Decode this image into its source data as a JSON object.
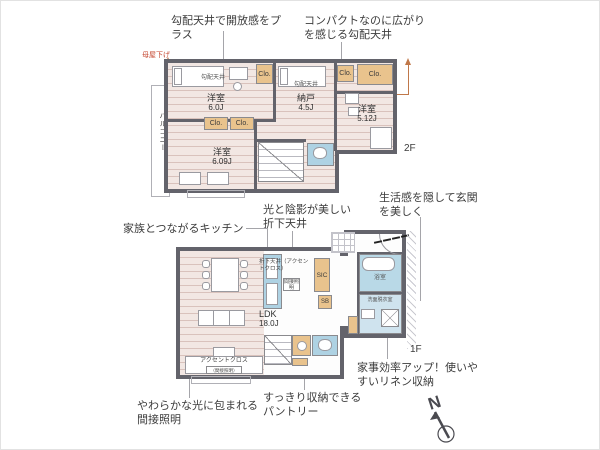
{
  "labels": {
    "clo": "Clo.",
    "kobai_tenjo": "勾配天井",
    "floor2": "2F",
    "floor1": "1F",
    "compass_n": "N"
  },
  "floor2": {
    "rooms": {
      "bedroom_60": {
        "name": "洋室",
        "size": "6.0J"
      },
      "storage_45": {
        "name": "納戸",
        "size": "4.5J"
      },
      "bedroom_512": {
        "name": "洋室",
        "size": "5.12J"
      },
      "bedroom_609": {
        "name": "洋室",
        "size": "6.09J"
      },
      "balcony": "バルコニー"
    }
  },
  "floor1": {
    "rooms": {
      "ldk": {
        "name": "LDK",
        "size": "18.0J"
      },
      "sic": "SIC",
      "sb": "SB",
      "bath": "浴室",
      "washroom": "洗面脱衣室"
    },
    "notes": {
      "kitchen_ceiling": "折下天井（アクセントクロス）",
      "indirect_box": "間接照明",
      "accent_cloth": "アクセントクロス",
      "accent_sub": "（間接照明）"
    }
  },
  "annotations": {
    "sloped_open": "勾配天井で開放感をプラス",
    "compact_sloped": "コンパクトなのに広がりを感じる勾配天井",
    "moya_sage": "母屋下げ",
    "family_kitchen": "家族とつながるキッチン",
    "light_shadow": "光と陰影が美しい折下天井",
    "hide_entrance": "生活感を隠して玄関を美しく",
    "linen": "家事効率アップ！使いやすいリネン収納",
    "pantry": "すっきり収納できるパントリー",
    "soft_light": "やわらかな光に包まれる間接照明"
  },
  "colors": {
    "wall": "#63636b",
    "floor": "#f2e7e3",
    "closet": "#e9c38d",
    "fixture_blue": "#aed2e3",
    "accent_line": "#c0784a"
  }
}
